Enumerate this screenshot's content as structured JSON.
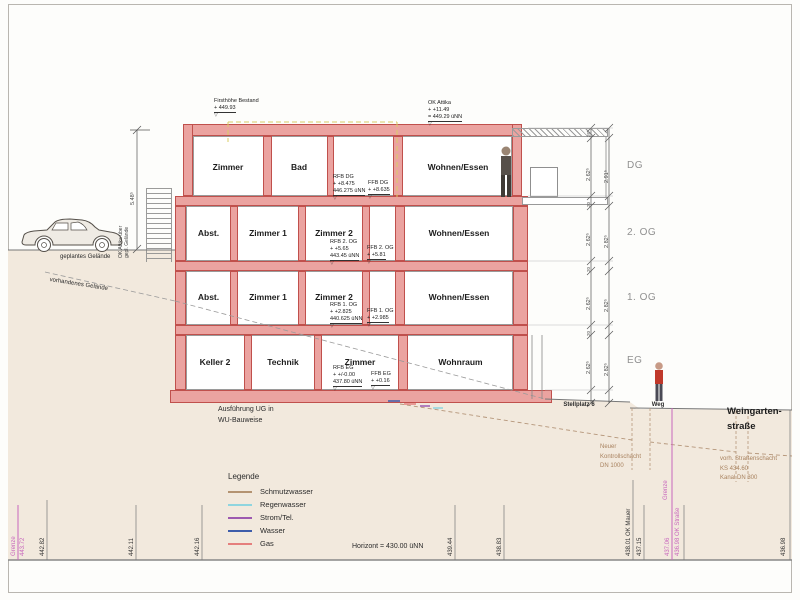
{
  "top": {
    "firsthoehe": [
      "Firsthöhe Bestand",
      "+ 449.93"
    ],
    "ok_attika": [
      "OK Attika",
      "+ +11.49",
      "= 449.29 üNN"
    ],
    "ok_attika_left": [
      "OK Attika über",
      "gepl. Gelände"
    ],
    "left_dim": "5.48⁵"
  },
  "floors": {
    "dg": {
      "label": "DG",
      "rooms": [
        "Zimmer",
        "Bad",
        "Wohnen/Essen"
      ],
      "rfb": [
        "RFB DG",
        "+ +8.475",
        "446.275 üNN"
      ],
      "ffb": [
        "FFB DG",
        "+ +8.635"
      ],
      "dim_outer": "2.62⁵",
      "dim_inner": "2.91⁵"
    },
    "og2": {
      "label": "2. OG",
      "rooms": [
        "Abst.",
        "Zimmer 1",
        "Zimmer 2",
        "Wohnen/Essen"
      ],
      "rfb": [
        "RFB 2. OG",
        "+ +5.65",
        "443.45 üNN"
      ],
      "ffb": [
        "FFB 2. OG",
        "+ +5.81"
      ],
      "dim_outer": "2.62⁵",
      "dim_inner": "2.82⁵"
    },
    "og1": {
      "label": "1. OG",
      "rooms": [
        "Abst.",
        "Zimmer 1",
        "Zimmer 2",
        "Wohnen/Essen"
      ],
      "rfb": [
        "RFB 1. OG",
        "+ +2.825",
        "440.625 üNN"
      ],
      "ffb": [
        "FFB 1. OG",
        "+ +2.985"
      ],
      "dim_outer": "2.62⁵",
      "dim_inner": "2.82⁵"
    },
    "eg": {
      "label": "EG",
      "rooms": [
        "Keller 2",
        "Technik",
        "Zimmer",
        "Wohnraum"
      ],
      "rfb": [
        "RFB EG",
        "+ +/-0.00",
        "437.80 üNN"
      ],
      "ffb": [
        "FFB EG",
        "+ +0.16"
      ],
      "dim_outer": "2.62⁵",
      "dim_inner": "2.82⁵"
    }
  },
  "dims": {
    "slab": [
      "26",
      "20",
      "20",
      "20"
    ]
  },
  "site": {
    "geplantes_gelaende": "geplantes Gelände",
    "vorhandenes_gelaende": "vorhandenes Gelände",
    "ausfuehrung": [
      "Ausführung UG in",
      "WU-Bauweise"
    ],
    "stellplatz": "Stellplatz 6",
    "weg": "Weg",
    "strasse": [
      "Weingarten-",
      "straße"
    ],
    "kontrollschacht": [
      "Neuer",
      "Kontrollschacht",
      "DN 1000"
    ],
    "strassenschacht": [
      "vorh. Straßenschacht",
      "KS 434.60",
      "Kanal DN 300"
    ],
    "horizont": "Horizont = 430.00 üNN"
  },
  "legend": {
    "title": "Legende",
    "items": [
      {
        "label": "Schmutzwasser",
        "color": "#b49371"
      },
      {
        "label": "Regenwasser",
        "color": "#8fd5df"
      },
      {
        "label": "Strom/Tel.",
        "color": "#9d5ab0"
      },
      {
        "label": "Wasser",
        "color": "#3e5daa"
      },
      {
        "label": "Gas",
        "color": "#e57f7d"
      }
    ]
  },
  "bottom": {
    "labels": [
      {
        "text": "Grenze",
        "pink": true
      },
      {
        "text": "443.72",
        "pink": true
      },
      {
        "text": "442.82"
      },
      {
        "text": "442.11"
      },
      {
        "text": "442.16"
      },
      {
        "text": "439.44"
      },
      {
        "text": "438.83"
      },
      {
        "text": "438.01 OK Mauer"
      },
      {
        "text": "437.15"
      },
      {
        "text": "Grenze",
        "pink": true
      },
      {
        "text": "437.06",
        "pink": true
      },
      {
        "text": "436.98 OK Straße",
        "pink": true
      },
      {
        "text": "436.98"
      }
    ]
  },
  "colors": {
    "wall": "#eba3a0",
    "wall_edge": "#c0504c",
    "ground": "#f2e9dd",
    "boundary_pink": "#c867bd",
    "bestand_dash": "#d8cc66",
    "pipe_brown": "#b5967a"
  }
}
